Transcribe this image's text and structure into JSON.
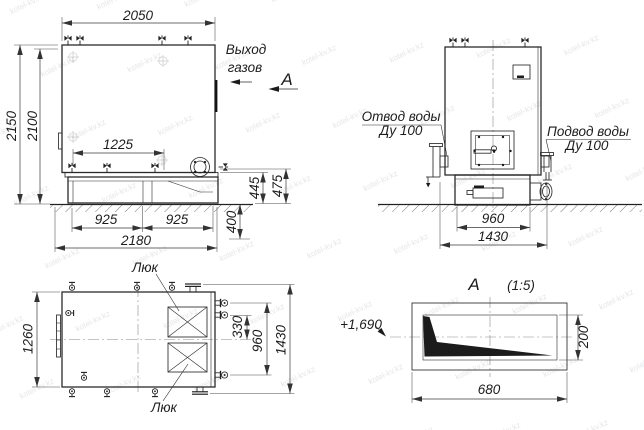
{
  "watermark": {
    "text": "kotel-kv.kz"
  },
  "side_view": {
    "dim_top_width": "2050",
    "dim_height_a": "2150",
    "dim_height_b": "2100",
    "dim_valves": "1225",
    "dim_support_left": "925",
    "dim_support_right": "925",
    "dim_foundation": "2180",
    "dim_pit_depth": "400",
    "dim_base_height_a": "445",
    "dim_base_height_b": "475"
  },
  "callouts": {
    "gas_outlet_line1": "Выход",
    "gas_outlet_line2": "газов",
    "view_letter": "А"
  },
  "front_view": {
    "water_outlet_line1": "Отвод воды",
    "water_outlet_line2": "Ду 100",
    "water_inlet_line1": "Подвод воды",
    "water_inlet_line2": "Ду 100",
    "dim_base_width": "960",
    "dim_total_width": "1430"
  },
  "plan_view": {
    "hatch_top": "Люк",
    "hatch_bottom": "Люк",
    "dim_width": "1260",
    "dim_stub_offset": "330",
    "dim_stub_span": "960",
    "dim_total_length": "1430"
  },
  "detail_a": {
    "title_letter": "А",
    "title_scale": "(1:5)",
    "elevation_mark": "+1,690",
    "dim_height": "200",
    "dim_length": "680"
  }
}
